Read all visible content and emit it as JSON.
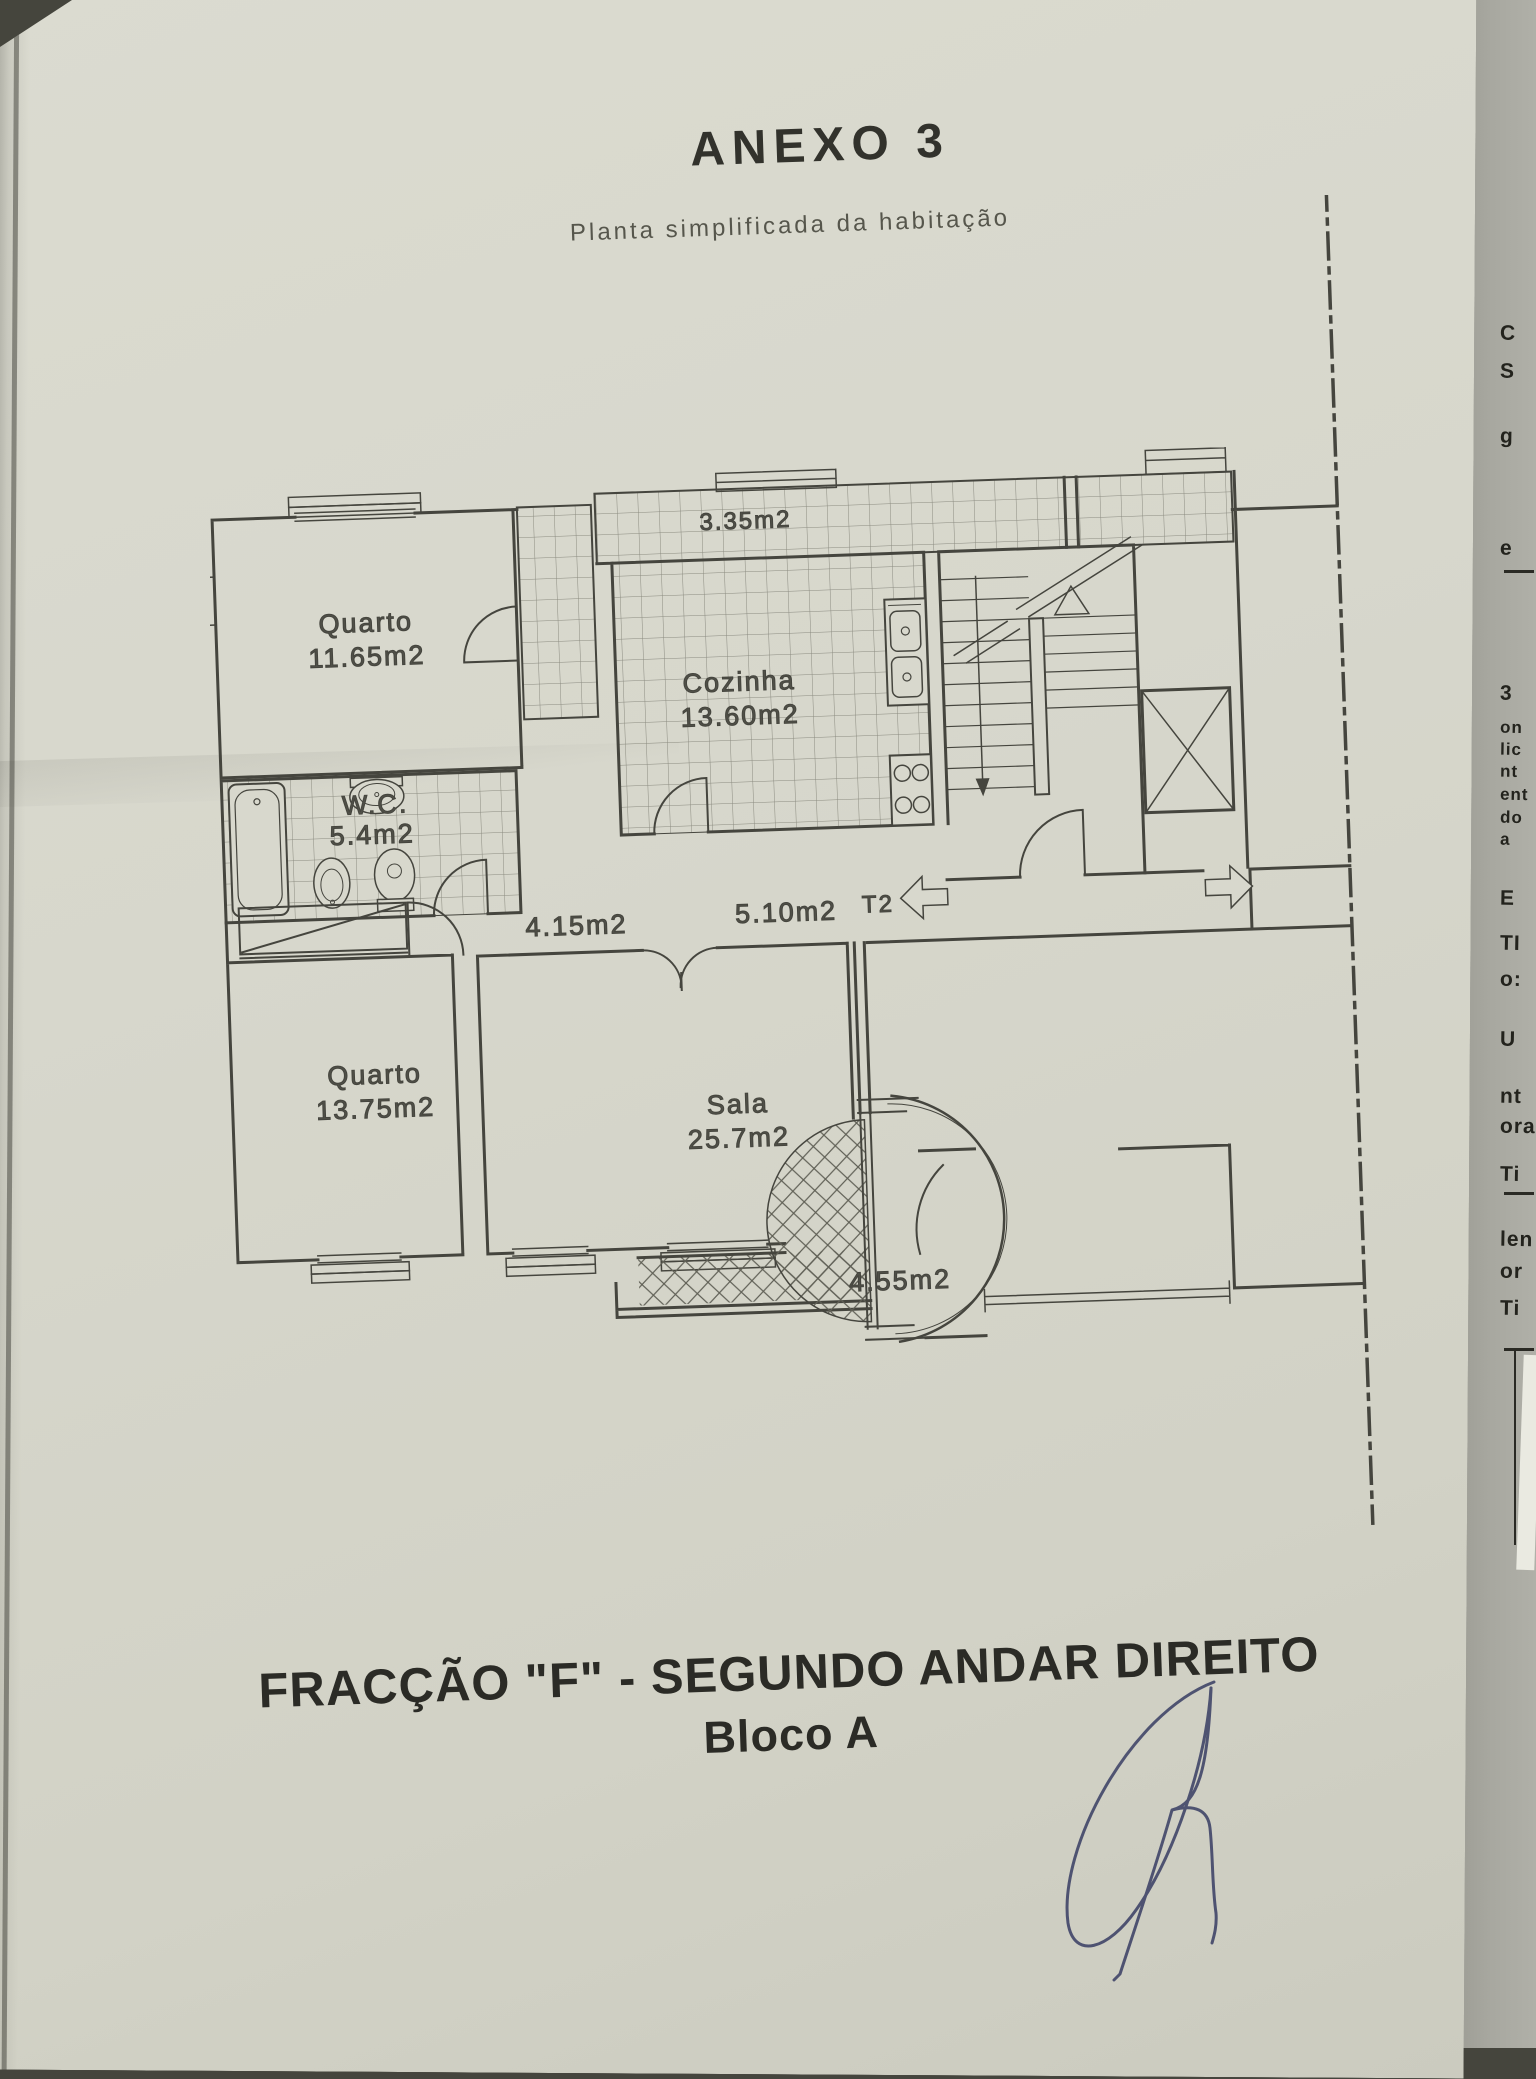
{
  "title": "ANEXO 3",
  "subtitle": "Planta simplificada da habitação",
  "plan": {
    "rooms": [
      {
        "name": "Quarto",
        "area": "11.65m2"
      },
      {
        "name": "Cozinha",
        "area": "13.60m2"
      },
      {
        "name": "W.C.",
        "area": "5.4m2"
      },
      {
        "name": "Quarto",
        "area": "13.75m2"
      },
      {
        "name": "Sala",
        "area": "25.7m2"
      }
    ],
    "zones": [
      {
        "label": "3.35m2"
      },
      {
        "label": "4.15m2"
      },
      {
        "label": "5.10m2"
      },
      {
        "label": "4.55m2"
      }
    ],
    "unit_type": "T2"
  },
  "footer": {
    "fraction": "FRACÇÃO \"F\"",
    "rest": " - SEGUNDO ANDAR DIREITO",
    "block": "Bloco A"
  },
  "edge_fragments": [
    "C",
    "S",
    "g",
    "e",
    "3",
    "on",
    "lic",
    "nt",
    "ent",
    "do",
    "a",
    "E",
    "TI",
    "o:",
    "U",
    "nt",
    "ora",
    "Ti",
    "len",
    "or",
    "Ti"
  ],
  "signature": {
    "ink_color": "#3d4266"
  },
  "colors": {
    "paper": "#d7d7cc",
    "plan_line": "#45453e",
    "label_text": "#505048",
    "under_page": "#a8a8a0",
    "footer_text": "#2b2b26"
  }
}
